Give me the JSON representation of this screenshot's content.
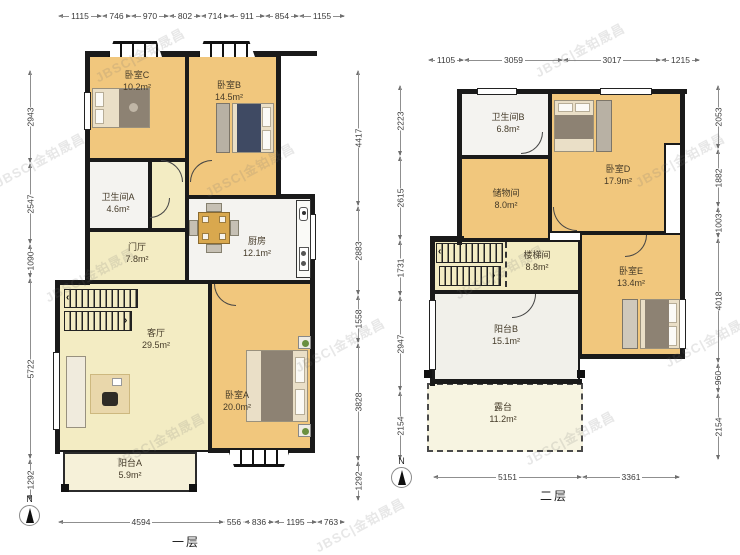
{
  "watermark": "JBSC|金铂晟昌",
  "floor1": {
    "label": "一层",
    "compass": "N",
    "dims_top": [
      "1115",
      "746",
      "970",
      "802",
      "714",
      "911",
      "854",
      "1155"
    ],
    "dims_left": [
      "2943",
      "2547",
      "1090",
      "5722",
      "1292"
    ],
    "dims_right": [
      "4417",
      "2883",
      "1558",
      "3828",
      "1292"
    ],
    "dims_bottom": [
      "4594",
      "556",
      "836",
      "1195",
      "763"
    ],
    "rooms": {
      "bedroomC": {
        "name": "卧室C",
        "area": "10.2m²"
      },
      "bedroomB": {
        "name": "卧室B",
        "area": "14.5m²"
      },
      "bathroomA": {
        "name": "卫生间A",
        "area": "4.6m²"
      },
      "hall": {
        "name": "门厅",
        "area": "7.8m²"
      },
      "kitchen": {
        "name": "厨房",
        "area": "12.1m²"
      },
      "living": {
        "name": "客厅",
        "area": "29.5m²"
      },
      "bedroomA": {
        "name": "卧室A",
        "area": "20.0m²"
      },
      "balconyA": {
        "name": "阳台A",
        "area": "5.9m²"
      }
    }
  },
  "floor2": {
    "label": "二层",
    "compass": "N",
    "dims_top": [
      "1105",
      "3059",
      "3017",
      "1215"
    ],
    "dims_left": [
      "2223",
      "2615",
      "1731",
      "2947",
      "2154"
    ],
    "dims_right": [
      "2053",
      "1882",
      "1003",
      "4018",
      "960",
      "2154"
    ],
    "dims_bottom": [
      "5151",
      "3361"
    ],
    "rooms": {
      "bathroomB": {
        "name": "卫生间B",
        "area": "6.8m²"
      },
      "bedroomD": {
        "name": "卧室D",
        "area": "17.9m²"
      },
      "storage": {
        "name": "储物间",
        "area": "8.0m²"
      },
      "stairwell": {
        "name": "楼梯间",
        "area": "8.8m²"
      },
      "bedroomE": {
        "name": "卧室E",
        "area": "13.4m²"
      },
      "balconyB": {
        "name": "阳台B",
        "area": "15.1m²"
      },
      "terrace": {
        "name": "露台",
        "area": "11.2m²"
      }
    }
  }
}
